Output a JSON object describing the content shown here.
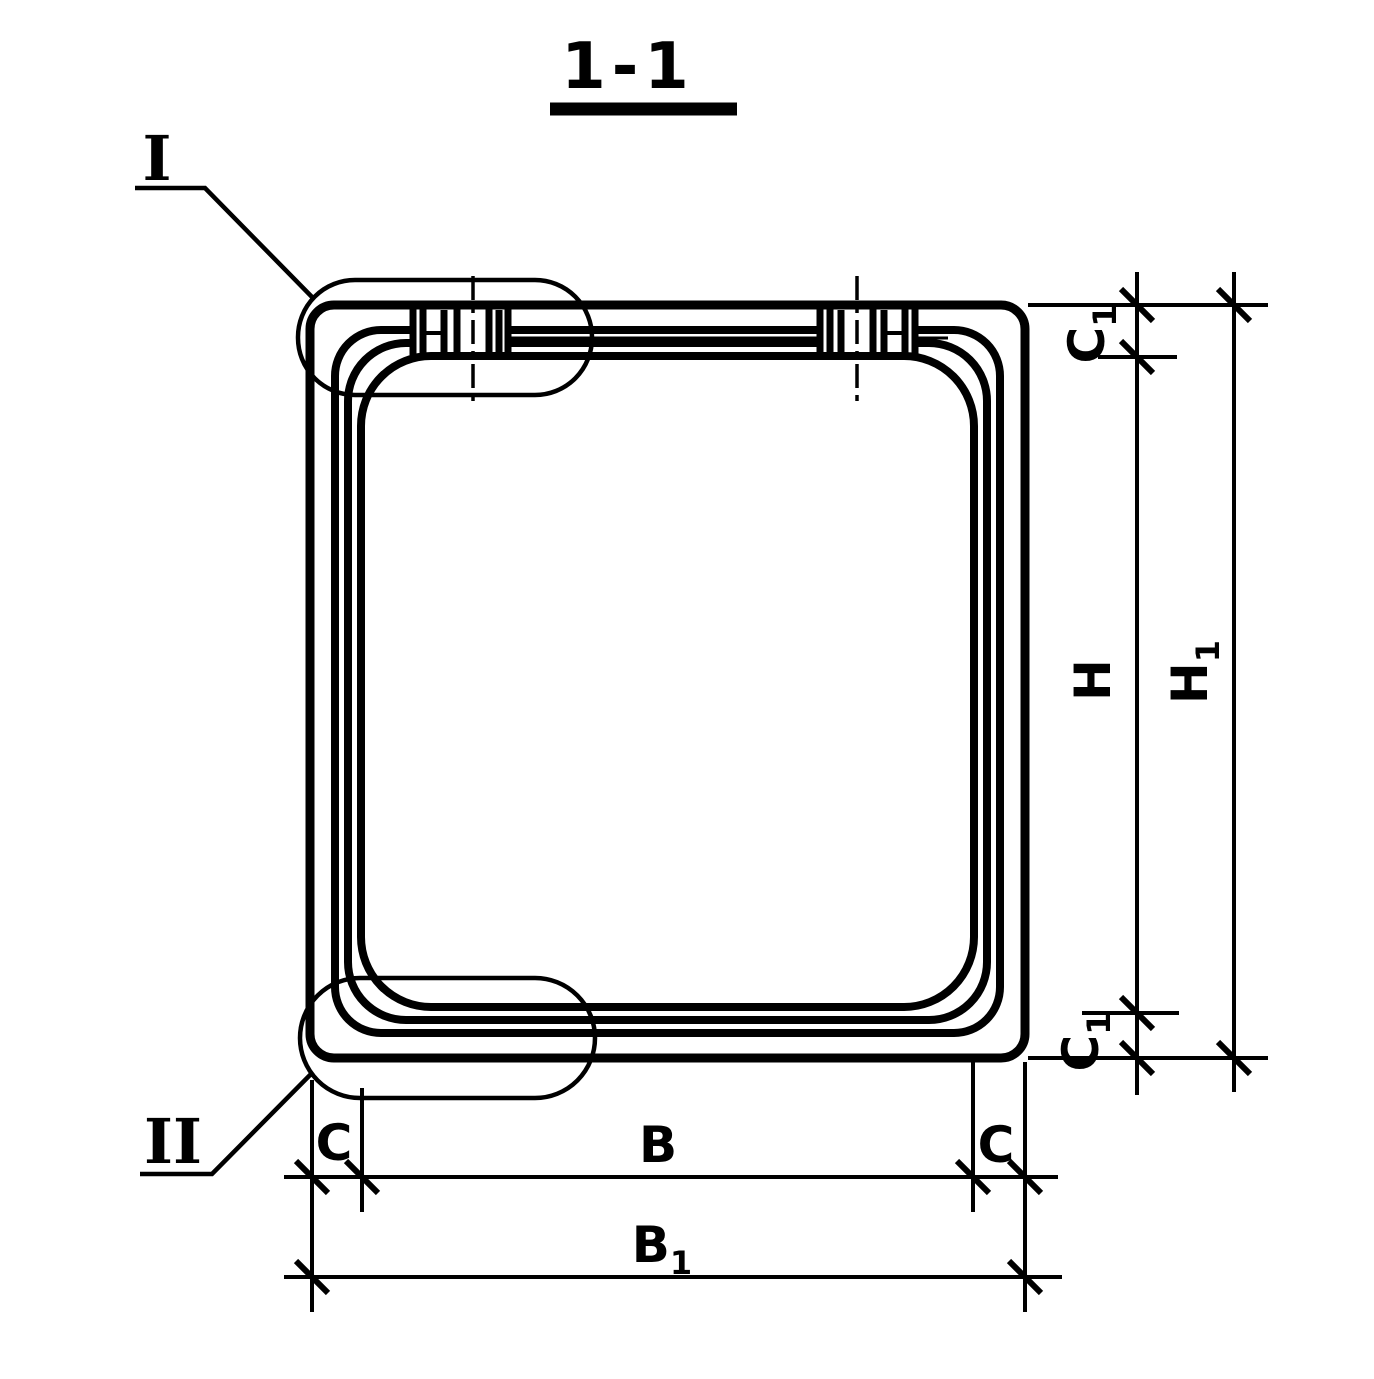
{
  "drawing": {
    "title": "1-1",
    "callouts": {
      "one": "I",
      "two": "II"
    },
    "dims": {
      "c1_top": {
        "base": "C",
        "sub": "1"
      },
      "h": {
        "base": "H",
        "sub": ""
      },
      "h1": {
        "base": "H",
        "sub": "1"
      },
      "c1_bottom": {
        "base": "C",
        "sub": "1"
      },
      "c_left": {
        "base": "C",
        "sub": ""
      },
      "b": {
        "base": "B",
        "sub": ""
      },
      "c_right": {
        "base": "C",
        "sub": ""
      },
      "b1": {
        "base": "B",
        "sub": "1"
      }
    },
    "colors": {
      "ink": "#000000",
      "paper": "#ffffff"
    }
  }
}
